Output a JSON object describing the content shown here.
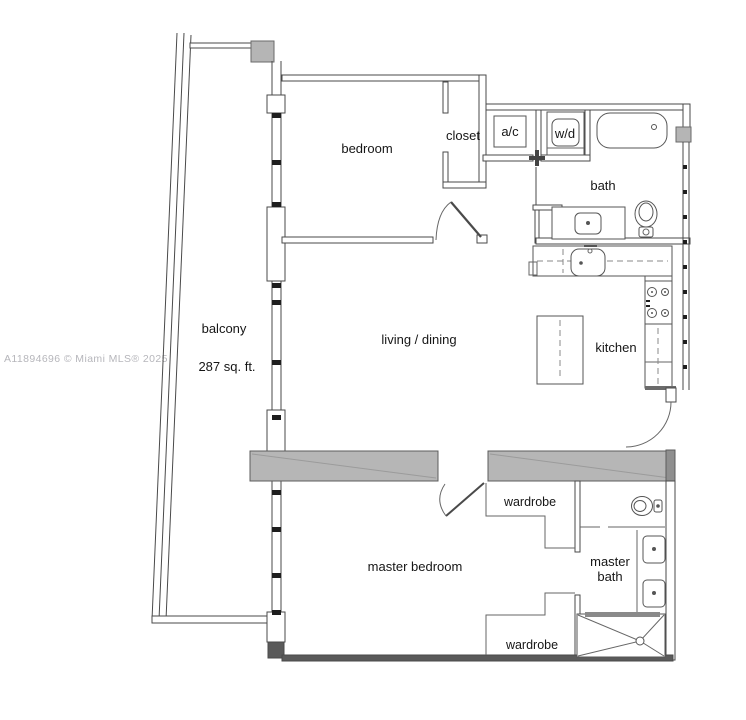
{
  "watermark": {
    "text": "A11894696 © Miami MLS® 2025",
    "color": "#b6b6bb"
  },
  "floor_plan": {
    "labels": {
      "bedroom": "bedroom",
      "closet": "closet",
      "ac": "a/c",
      "wd": "w/d",
      "bath": "bath",
      "living_dining": "living / dining",
      "kitchen": "kitchen",
      "balcony": "balcony",
      "balcony_area": "287 sq. ft.",
      "wardrobe_upper": "wardrobe",
      "wardrobe_lower": "wardrobe",
      "master_bedroom": "master bedroom",
      "master_bath_line1": "master",
      "master_bath_line2": "bath"
    },
    "colors": {
      "wall": "#4a4a4a",
      "fixture": "#555555",
      "gray_fill": "#b6b6b6",
      "label": "#161616",
      "watermark": "#b6b6bb",
      "background": "#ffffff"
    }
  }
}
